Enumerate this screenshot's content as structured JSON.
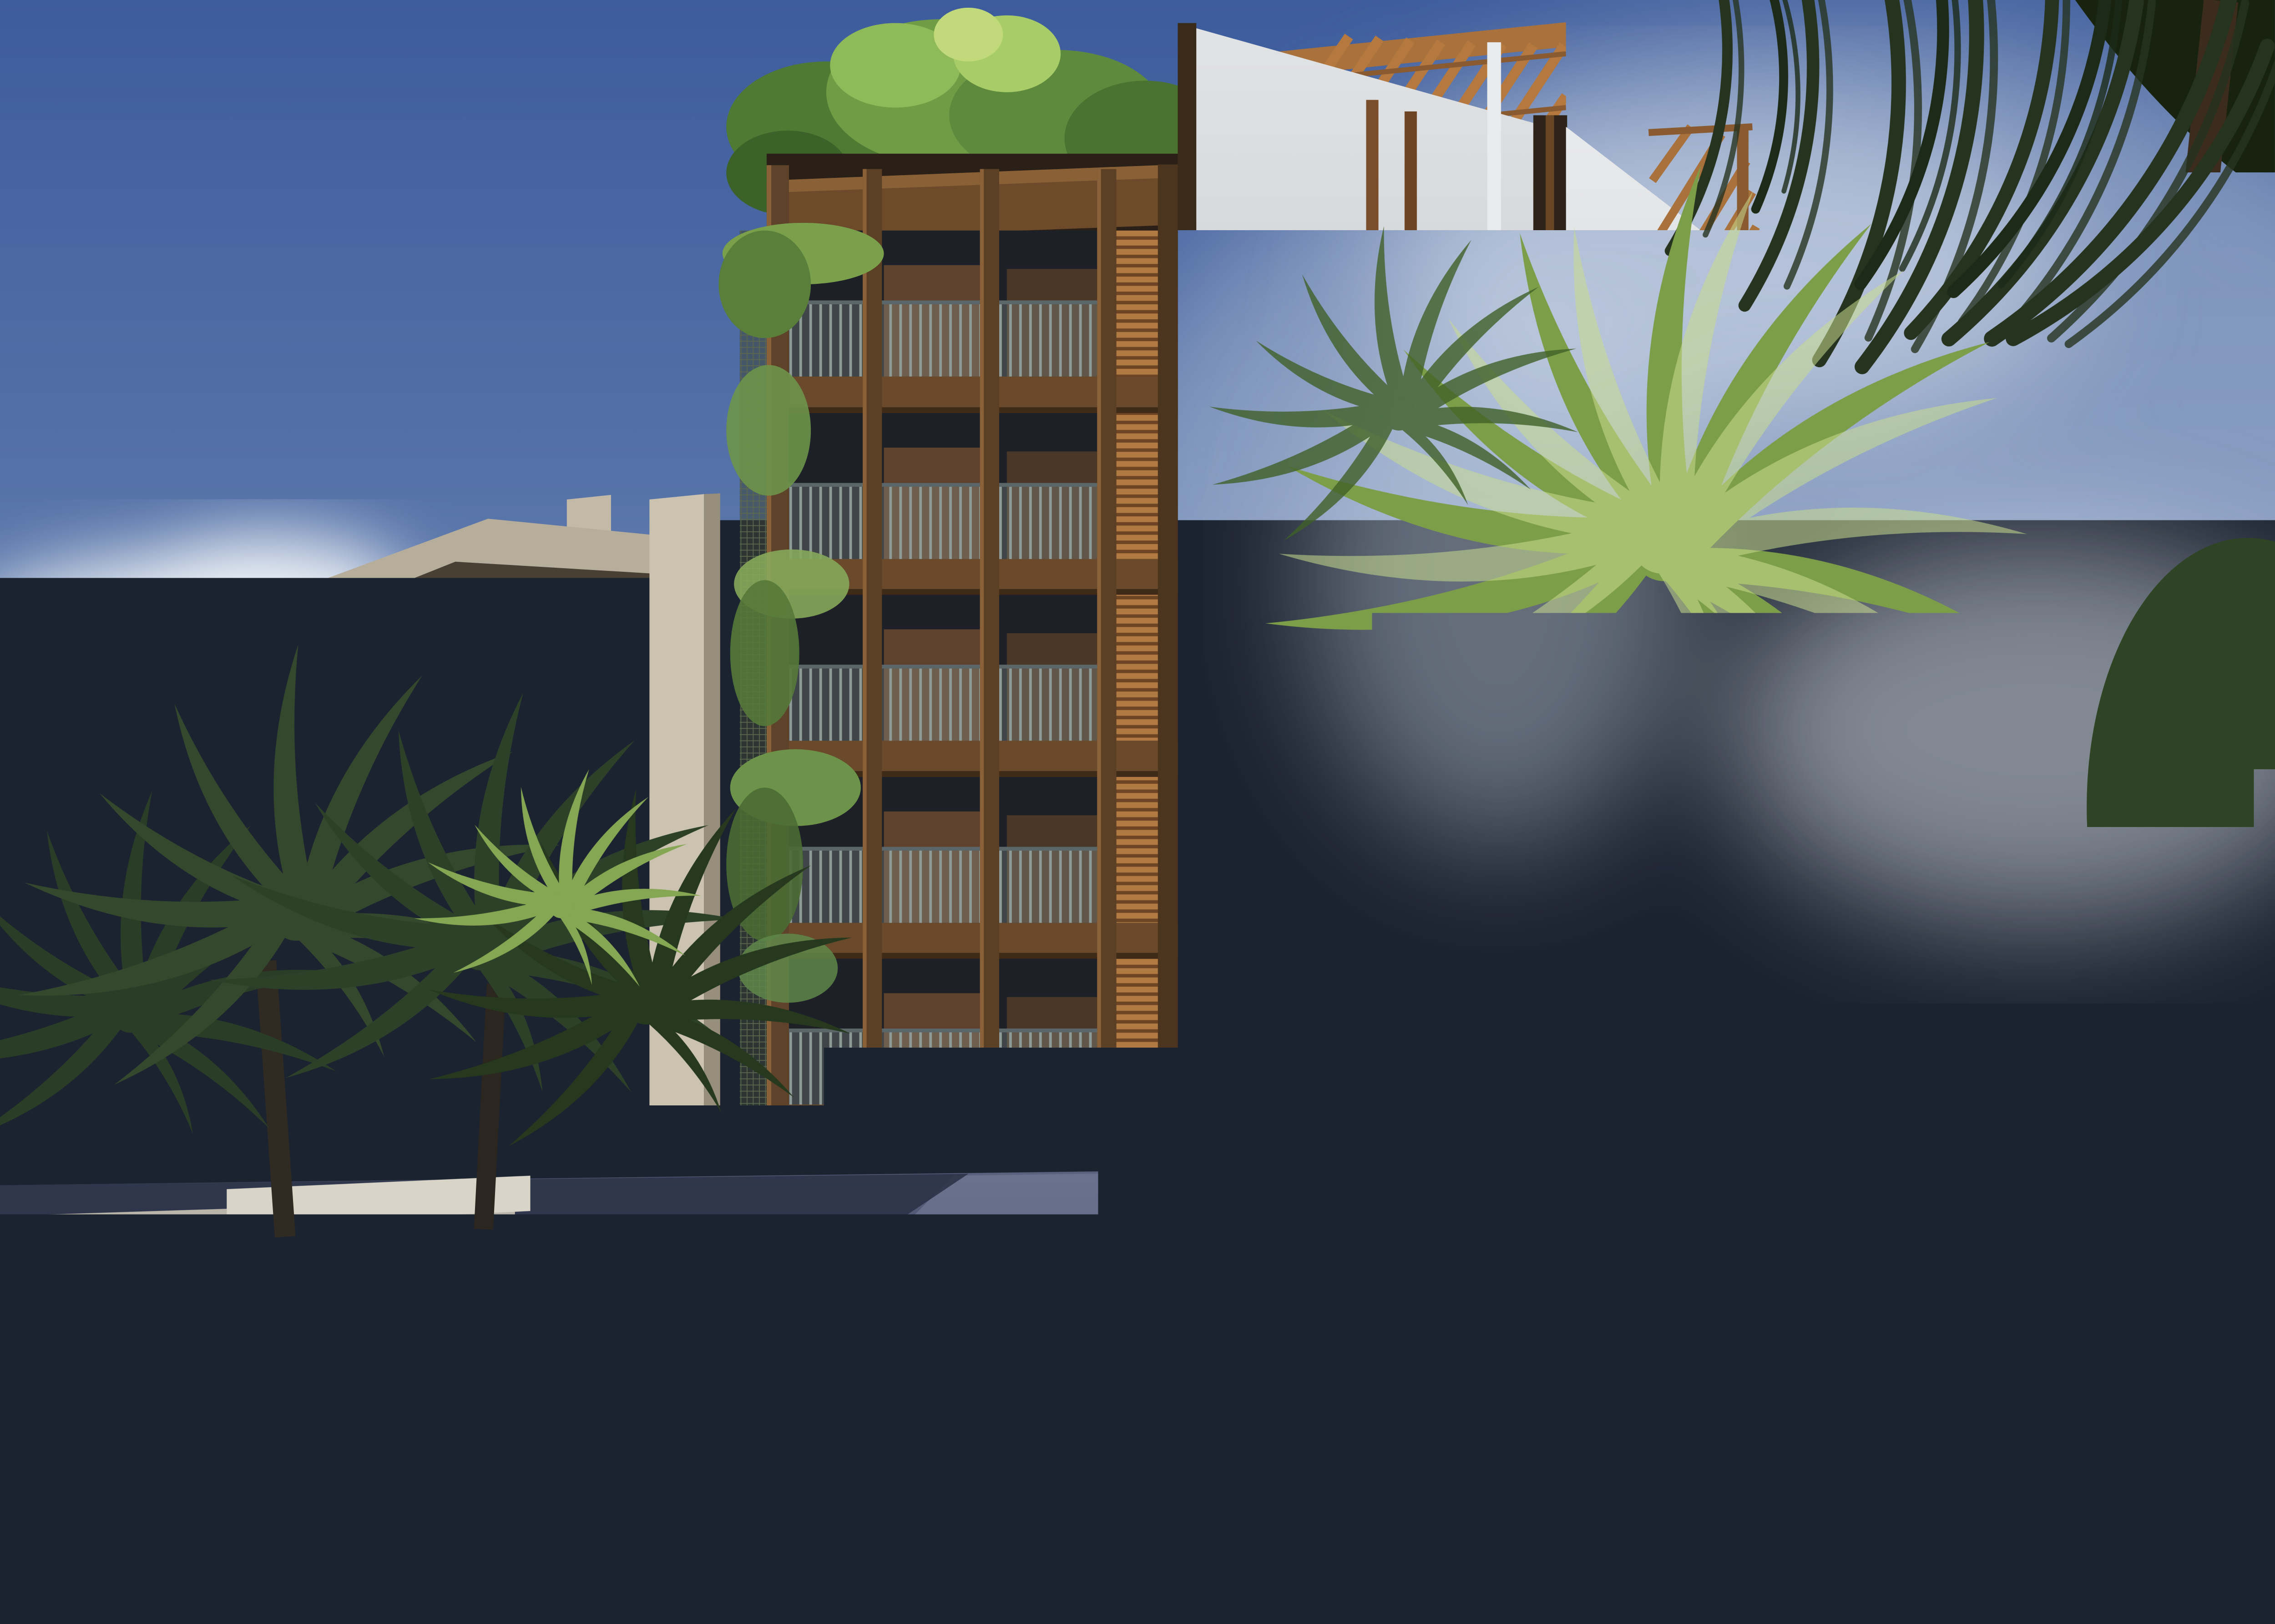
{
  "scene": {
    "type": "photorealistic architectural rendering",
    "setting": "Boutique wood-and-glass apartment tower with rooftop greenery and a grayscale mural side wall, beside a beige concrete condo building, tropical palms, and cars parked on a half-shaded street under a blue sky",
    "sign": {
      "emblem": "circular white botanical emblem",
      "title": "BAGÀ RIVIERA",
      "subtitle": "APARTMENTS"
    },
    "mural": "black-and-white organic eye artwork on large wall panels",
    "vehicles": [
      {
        "name": "dark SUV parked in shade",
        "color": "#20242b"
      },
      {
        "name": "black sports coupe",
        "color": "#0e1015"
      },
      {
        "name": "white car in foreground (cropped)",
        "color": "#e8ebee"
      }
    ],
    "colors": {
      "sky_top": "#3d5c9c",
      "sky_horizon": "#a7b6cc",
      "cloud": "#f2f5f8",
      "beige_building": "#a89f8e",
      "wood_frame": "#5f422a",
      "wood_slats": "#b07a42",
      "mural_light": "#d2d3d5",
      "mural_dark": "#6e7073",
      "foliage_dark": "#22351f",
      "foliage_bright": "#8fae52",
      "road_shadow": "#2a3146",
      "road_sunlit": "#79819c",
      "curb": "#d8d4c8",
      "sign_bg": "#0f0d0a",
      "sign_text": "#f2efe8"
    }
  }
}
